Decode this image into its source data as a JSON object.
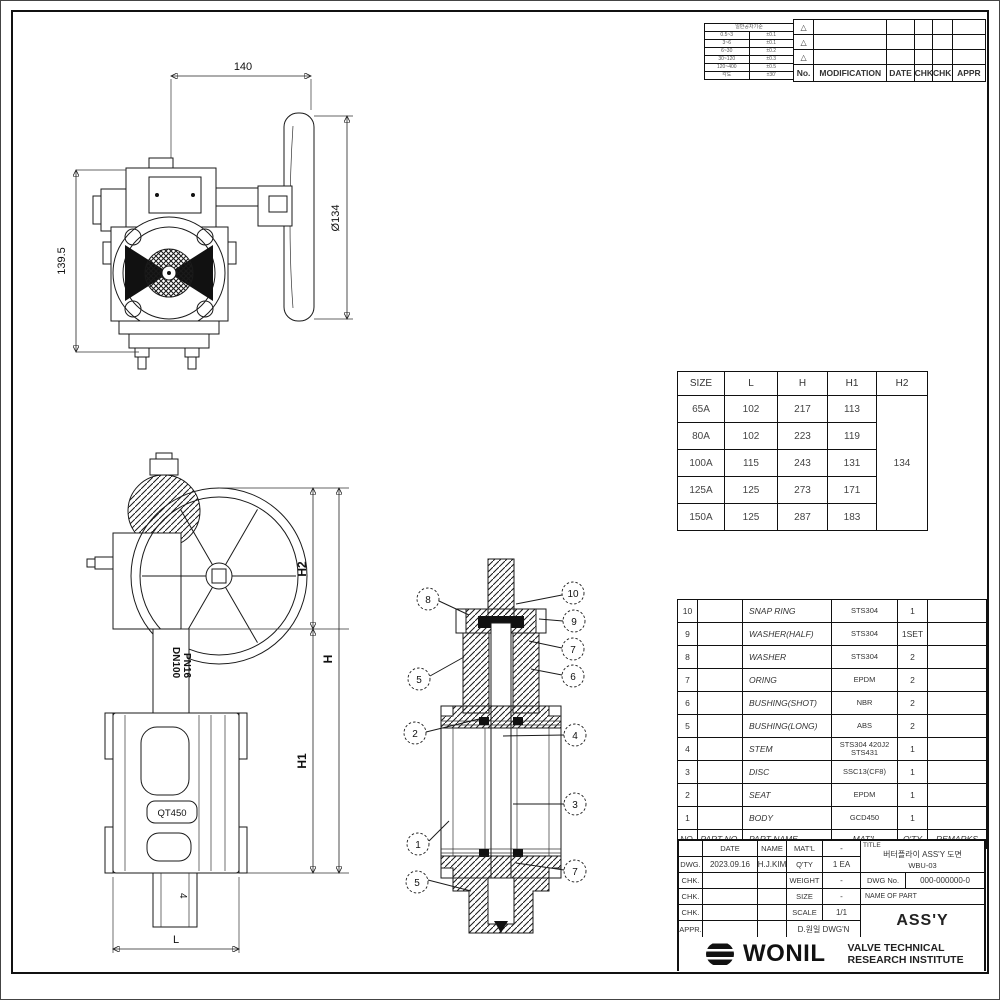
{
  "front_view": {
    "dim_top": "140",
    "dim_wheel": "Ø134",
    "dim_left": "139.5"
  },
  "side_view": {
    "dim_h2": "H2",
    "dim_h": "H",
    "dim_h1": "H1",
    "neck_label_line1": "DN100",
    "neck_label_line2": "PN16",
    "body_mark": "QT450",
    "lug_mark": "4",
    "dim_l": "L"
  },
  "section_view": {
    "balloons_left": [
      "8",
      "5",
      "2",
      "1",
      "5"
    ],
    "balloons_right": [
      "10",
      "9",
      "7",
      "6",
      "4",
      "3",
      "7"
    ]
  },
  "tolerance_table": {
    "title": "일반공차기준",
    "rows": [
      [
        "0.5~3",
        "±0.1"
      ],
      [
        "3~6",
        "±0.1"
      ],
      [
        "6~30",
        "±0.2"
      ],
      [
        "30~120",
        "±0.3"
      ],
      [
        "120~400",
        "±0.5"
      ]
    ],
    "footer": [
      "각도",
      "±30'"
    ]
  },
  "revision_table": {
    "headers": [
      "No.",
      "MODIFICATION",
      "DATE",
      "CHK",
      "CHK",
      "APPR"
    ],
    "marks": [
      "△",
      "△",
      "△"
    ]
  },
  "dimension_table": {
    "headers": [
      "SIZE",
      "L",
      "H",
      "H1",
      "H2"
    ],
    "rows": [
      [
        "65A",
        "102",
        "217",
        "113"
      ],
      [
        "80A",
        "102",
        "223",
        "119"
      ],
      [
        "100A",
        "115",
        "243",
        "131"
      ],
      [
        "125A",
        "125",
        "273",
        "171"
      ],
      [
        "150A",
        "125",
        "287",
        "183"
      ]
    ],
    "h2_value": "134"
  },
  "bom_table": {
    "headers": [
      "NO.",
      "PART NO.",
      "PART NAME",
      "MAT'L",
      "Q'TY",
      "REMARKS"
    ],
    "rows": [
      [
        "10",
        "",
        "SNAP RING",
        "STS304",
        "1",
        ""
      ],
      [
        "9",
        "",
        "WASHER(HALF)",
        "STS304",
        "1SET",
        ""
      ],
      [
        "8",
        "",
        "WASHER",
        "STS304",
        "2",
        ""
      ],
      [
        "7",
        "",
        "ORING",
        "EPDM",
        "2",
        ""
      ],
      [
        "6",
        "",
        "BUSHING(SHOT)",
        "NBR",
        "2",
        ""
      ],
      [
        "5",
        "",
        "BUSHING(LONG)",
        "ABS",
        "2",
        ""
      ],
      [
        "4",
        "",
        "STEM",
        "STS304 420J2 STS431",
        "1",
        ""
      ],
      [
        "3",
        "",
        "DISC",
        "SSC13(CF8)",
        "1",
        ""
      ],
      [
        "2",
        "",
        "SEAT",
        "EPDM",
        "1",
        ""
      ],
      [
        "1",
        "",
        "BODY",
        "GCD450",
        "1",
        ""
      ]
    ]
  },
  "title_block": {
    "col_date": "DATE",
    "col_name": "NAME",
    "row_labels": [
      "DWG.",
      "CHK.",
      "CHK.",
      "CHK.",
      "APPR."
    ],
    "dwg_date": "2023.09.16",
    "dwg_name": "H.J.KIM",
    "specs": [
      {
        "key": "MAT'L",
        "value": "-"
      },
      {
        "key": "Q'TY",
        "value": "1 EA"
      },
      {
        "key": "WEIGHT",
        "value": "-"
      },
      {
        "key": "SIZE",
        "value": "-"
      },
      {
        "key": "SCALE",
        "value": "1/1"
      }
    ],
    "stamp": "D.원일 DWG'N",
    "title_label": "TITLE",
    "title_line1": "버터플라이 ASS'Y 도면",
    "title_line2": "WBU-03",
    "dwg_no_label": "DWG No.",
    "dwg_no": "000-000000-0",
    "part_label": "NAME OF PART",
    "part_value": "ASS'Y"
  },
  "footer": {
    "logo_text": "WONIL",
    "institute_line1": "VALVE TECHNICAL",
    "institute_line2": "RESEARCH INSTITUTE"
  }
}
